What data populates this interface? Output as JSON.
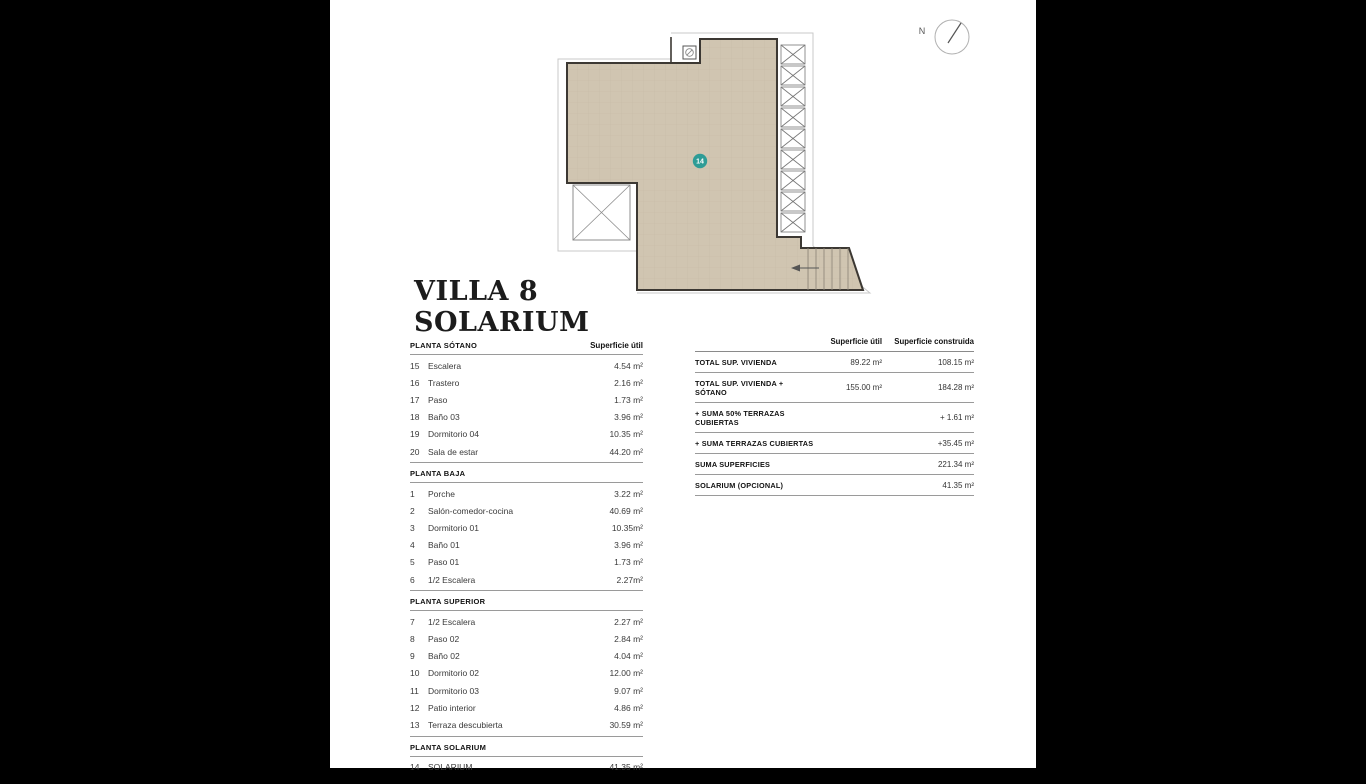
{
  "page": {
    "background": "#000000",
    "paper": "#ffffff"
  },
  "title": {
    "line1": "VILLA 8",
    "line2": "SOLARIUM"
  },
  "compass": {
    "north_label": "N"
  },
  "plan": {
    "room_badge": "14",
    "floor_color": "#d0c5b1",
    "badge_color": "#2e9c96",
    "wall_color": "#3c3833"
  },
  "floor_tables": {
    "sections": [
      {
        "heading": "PLANTA SÓTANO",
        "col_header": "Superficie útil",
        "rows": [
          [
            "15",
            "Escalera",
            "4.54 m²"
          ],
          [
            "16",
            "Trastero",
            "2.16 m²"
          ],
          [
            "17",
            "Paso",
            "1.73 m²"
          ],
          [
            "18",
            "Baño 03",
            "3.96 m²"
          ],
          [
            "19",
            "Dormitorio 04",
            "10.35 m²"
          ],
          [
            "20",
            "Sala de estar",
            "44.20 m²"
          ]
        ]
      },
      {
        "heading": "PLANTA BAJA",
        "rows": [
          [
            "1",
            "Porche",
            "3.22 m²"
          ],
          [
            "2",
            "Salón-comedor-cocina",
            "40.69 m²"
          ],
          [
            "3",
            "Dormitorio 01",
            "10.35m²"
          ],
          [
            "4",
            "Baño 01",
            "3.96 m²"
          ],
          [
            "5",
            "Paso 01",
            "1.73 m²"
          ],
          [
            "6",
            "1/2 Escalera",
            "2.27m²"
          ]
        ]
      },
      {
        "heading": "PLANTA SUPERIOR",
        "rows": [
          [
            "7",
            "1/2 Escalera",
            "2.27 m²"
          ],
          [
            "8",
            "Paso 02",
            "2.84 m²"
          ],
          [
            "9",
            "Baño 02",
            "4.04 m²"
          ],
          [
            "10",
            "Dormitorio 02",
            "12.00 m²"
          ],
          [
            "11",
            "Dormitorio 03",
            "9.07 m²"
          ],
          [
            "12",
            "Patio interior",
            "4.86 m²"
          ],
          [
            "13",
            "Terraza descubierta",
            "30.59 m²"
          ]
        ]
      },
      {
        "heading": "PLANTA SOLARIUM",
        "rows": [
          [
            "14",
            "SOLARIUM",
            "41.35 m²"
          ]
        ]
      }
    ]
  },
  "summary_table": {
    "col1_header": "Superficie útil",
    "col2_header": "Superficie construida",
    "rows": [
      {
        "label": "TOTAL SUP. VIVIENDA",
        "util": "89.22 m²",
        "construida": "108.15 m²"
      },
      {
        "label": "TOTAL SUP. VIVIENDA + SÓTANO",
        "util": "155.00 m²",
        "construida": "184.28 m²"
      },
      {
        "label": "+ SUMA 50% TERRAZAS CUBIERTAS",
        "util": "",
        "construida": "+ 1.61 m²"
      },
      {
        "label": "+ SUMA TERRAZAS CUBIERTAS",
        "util": "",
        "construida": "+35.45 m²"
      },
      {
        "label": "SUMA SUPERFICIES",
        "util": "",
        "construida": "221.34 m²"
      },
      {
        "label": "SOLARIUM (OPCIONAL)",
        "util": "",
        "construida": "41.35 m²"
      }
    ]
  }
}
